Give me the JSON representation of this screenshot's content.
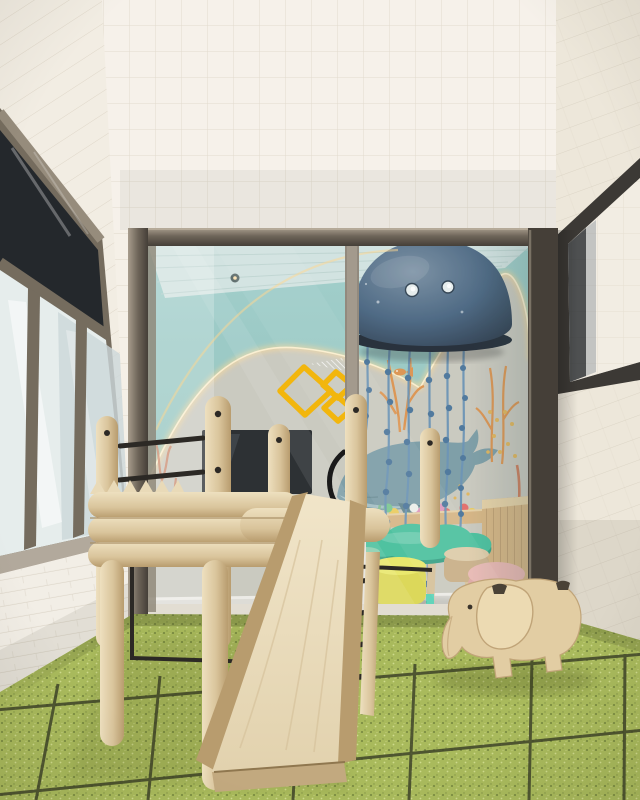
{
  "scene": {
    "objects": [
      "white-grid-tile-walls",
      "left-wall-windows",
      "right-wall-window",
      "white-brick-wainscot",
      "glass-play-cabin",
      "cabin-frame",
      "underwater-mural",
      "whale-illustration",
      "coral-illustrations",
      "kelp-illustrations",
      "jellyfish-ceiling-lamp",
      "beaded-lamp-strands",
      "led-arch-light",
      "ceiling-spotlights",
      "wall-tv-screen",
      "ball-pit",
      "wooden-bench",
      "cloud-kids-table",
      "mint-pouf",
      "yellow-pouf",
      "wooden-stool",
      "pink-stool",
      "yellow-logo-decal",
      "door-handle",
      "wooden-climbing-frame",
      "monkey-bar-rungs",
      "wooden-slide",
      "ladder-rungs",
      "green-rubber-tile-floor",
      "wooden-elephant-toy"
    ]
  },
  "colors": {
    "tile": "#f5f0e7",
    "grout": "#d9d1c1",
    "tile_left": "#f2ede3",
    "tile_right": "#ede7da",
    "brick": "#f2eee6",
    "brick_line": "#dcd5c8",
    "frame_window": "#3c3935",
    "frame_taupe": "#756c5e",
    "frame_taupe_light": "#968c7c",
    "glass_dark": "#24282c",
    "glass_frost": "#e6edec",
    "glass_frost_dim": "#ccd7d9",
    "frame_cabin": "#6e6559",
    "frame_cabin_light": "#a89d8d",
    "frame_cabin_dark": "#453f38",
    "ceiling_blue": "#d2e3e1",
    "wall_teal": "#9bccc7",
    "led": "#ffd88f",
    "led_core": "#fff0cc",
    "mural_concrete": "#c9c6bb",
    "whale_body": "#7496a0",
    "whale_belly": "#a9c2c6",
    "whale_dark": "#587b86",
    "coral_orange": "#dd8c42",
    "coral_yellow": "#e3b14f",
    "coral_red": "#cc7350",
    "kelp_green": "#7cb98b",
    "plant_pale": "#b9d4ae",
    "jelly_hi": "#71879c",
    "jelly_mid": "#3d5a78",
    "jelly_dark": "#1d2b3e",
    "jelly_rim": "#121a26",
    "strand_blue": "#5f8ab0",
    "strand_knot": "#3f6b94",
    "tv_black": "#16181c",
    "bench_wood": "#d6b07a",
    "bench_slat": "#b08d5c",
    "table_teal": "#3dbd97",
    "table_teal_dark": "#27997a",
    "leg_wood": "#d6bd92",
    "leg_tip": "#52d2b4",
    "pouf_mint": "#82cda9",
    "pouf_mint_dark": "#5fb58d",
    "pouf_yellow": "#ece95e",
    "pouf_yellow_dark": "#ddd747",
    "stool_wood": "#e0c9a2",
    "stool_wood_dark": "#c8a97d",
    "stool_pink": "#ecb3ad",
    "stool_pink_dark": "#dfa09b",
    "interior_floor": "#dedbd4",
    "floor_green": "#a9ba5c",
    "speck_dark": "#74863e",
    "speck_light": "#cfdb8d",
    "floor_grout": "#3f4429",
    "wood_light": "#eee0bf",
    "wood_mid": "#d9c49b",
    "wood_dark": "#b89c6e",
    "slide_face": "#f1e5c9",
    "slide_grain": "#d5c29b",
    "metal_black": "#2c2925",
    "elephant_body": "#e2cda3",
    "elephant_ear": "#ecdab2",
    "elephant_line": "#c0a478",
    "logo_yellow": "#f2b60d",
    "ball_red": "#e5625f",
    "ball_blue": "#58a8dc",
    "ball_yellow": "#edc94f",
    "ball_green": "#72c487",
    "ball_pink": "#e08fb8",
    "ball_white": "#f0f0ea"
  }
}
